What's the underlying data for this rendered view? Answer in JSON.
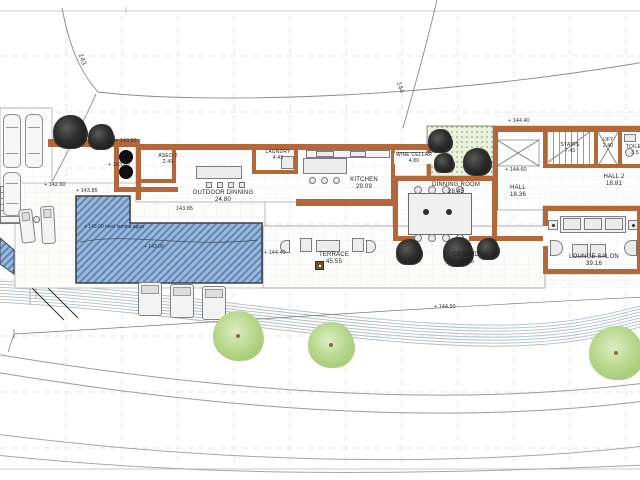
{
  "rooms": {
    "aseo2": {
      "name": "ASEO 2",
      "area": "2.49"
    },
    "outdoor_dinning": {
      "name": "OUTDOOR DINNING",
      "area": "24.80"
    },
    "laundry": {
      "name": "LAUNDRY",
      "area": "4.43"
    },
    "kitchen": {
      "name": "KITCHEN",
      "area": "29.09"
    },
    "wine_cellar": {
      "name": "WINE CELLAR",
      "area": "4.80"
    },
    "dinning_room": {
      "name": "DINNING ROOM",
      "area": "28.45"
    },
    "hall": {
      "name": "HALL",
      "area": "18.36"
    },
    "stairs": {
      "name": "STAIRS",
      "area": "7.43"
    },
    "lift": {
      "name": "LIFT",
      "area": "2.40"
    },
    "toilet": {
      "name": "TOILET",
      "area": "3.5"
    },
    "hall2": {
      "name": "HALL 2",
      "area": "18.81"
    },
    "lounge_salon": {
      "name": "LOUNGE SALON",
      "area": "39.16"
    },
    "terrace": {
      "name": "TERRACE",
      "area": "45.55"
    },
    "cesped": {
      "name": "CESPED",
      "area": "45.55"
    }
  },
  "levels": {
    "l1": "+ 143.50",
    "l2": "+ 143.60",
    "l3": "+ 142.60",
    "l4": "+ 143.85",
    "l5": "143.85",
    "l6": "+ 144.40",
    "l7": "+ 144.60",
    "l8": "+ 144.40",
    "l9": "+ 144.50",
    "pool_level": "+ 143.00 nivel lamina agua",
    "pool_level2": "+ 143.00"
  },
  "contours": {
    "c143": "143",
    "c144": "144"
  },
  "colors": {
    "wall": "#b4683a",
    "pool_fill": "#9db9d8",
    "pool_hatch": "#5c86ba",
    "patio_green": "#eaf1dc",
    "tree_dark": "#1a1a1a",
    "tree_green": "#9cc46a"
  }
}
